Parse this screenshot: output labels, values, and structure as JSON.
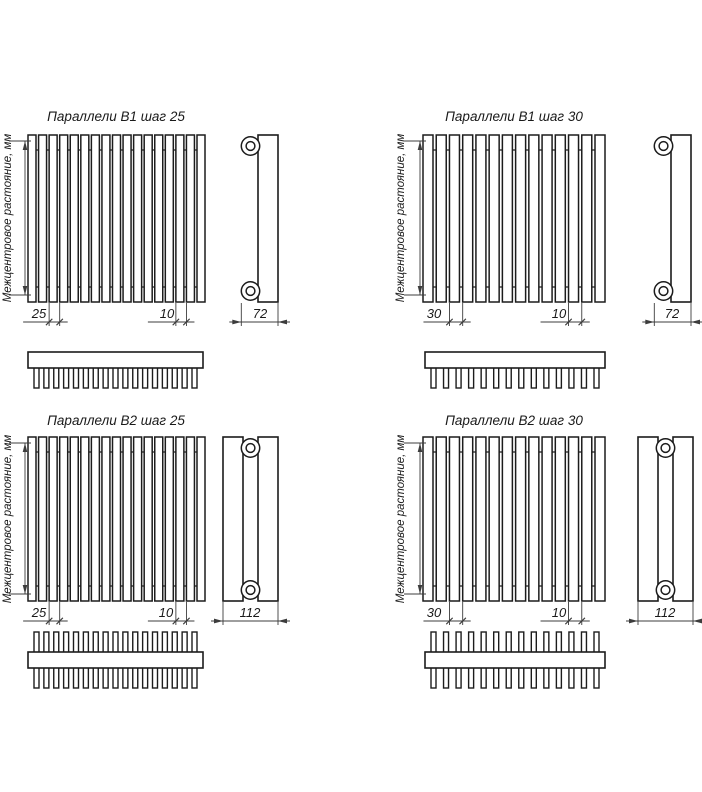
{
  "page": {
    "background": "#ffffff",
    "line_color": "#1c1c1c",
    "dim_color": "#3c3c3c",
    "text_color": "#1a1a1a"
  },
  "shared": {
    "axis_label": "Межцентровое растояние, мм"
  },
  "units": [
    {
      "title": "Параллели В1 шаг 25",
      "step_label": "25",
      "tube_width_label": "10",
      "depth_label": "72",
      "tubes": 17,
      "rows": 1
    },
    {
      "title": "Параллели В1 шаг 30",
      "step_label": "30",
      "tube_width_label": "10",
      "depth_label": "72",
      "tubes": 14,
      "rows": 1
    },
    {
      "title": "Параллели В2 шаг 25",
      "step_label": "25",
      "tube_width_label": "10",
      "depth_label": "112",
      "tubes": 17,
      "rows": 2
    },
    {
      "title": "Параллели В2 шаг 30",
      "step_label": "30",
      "tube_width_label": "10",
      "depth_label": "112",
      "tubes": 14,
      "rows": 2
    }
  ]
}
